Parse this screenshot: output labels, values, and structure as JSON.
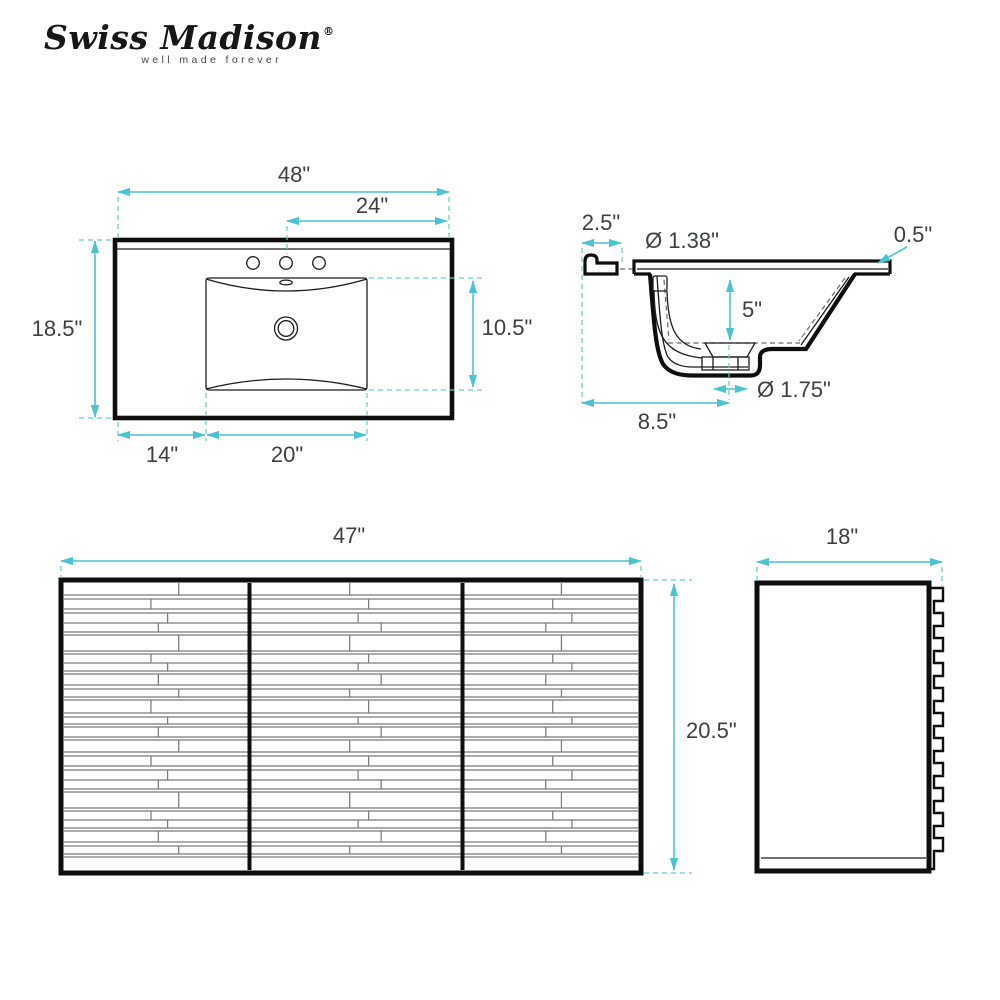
{
  "brand": {
    "name": "Swiss Madison",
    "registered": "®",
    "tagline": "well made forever"
  },
  "accent_color": "#4ac4cf",
  "line_color": "#0e0e0e",
  "views": {
    "sink_top": {
      "overall_width": "48\"",
      "faucet_to_edge": "24\"",
      "overall_depth": "18.5\"",
      "basin_depth": "10.5\"",
      "edge_to_basin": "14\"",
      "basin_width": "20\""
    },
    "sink_section": {
      "backsplash_width": "2.5\"",
      "faucet_hole_diameter": "Ø 1.38\"",
      "counter_thickness": "0.5\"",
      "basin_inner_depth": "5\"",
      "drain_diameter": "Ø 1.75\"",
      "edge_to_drain": "8.5\""
    },
    "cabinet_front": {
      "width": "47\"",
      "height": "20.5\""
    },
    "cabinet_side": {
      "depth": "18\""
    }
  }
}
